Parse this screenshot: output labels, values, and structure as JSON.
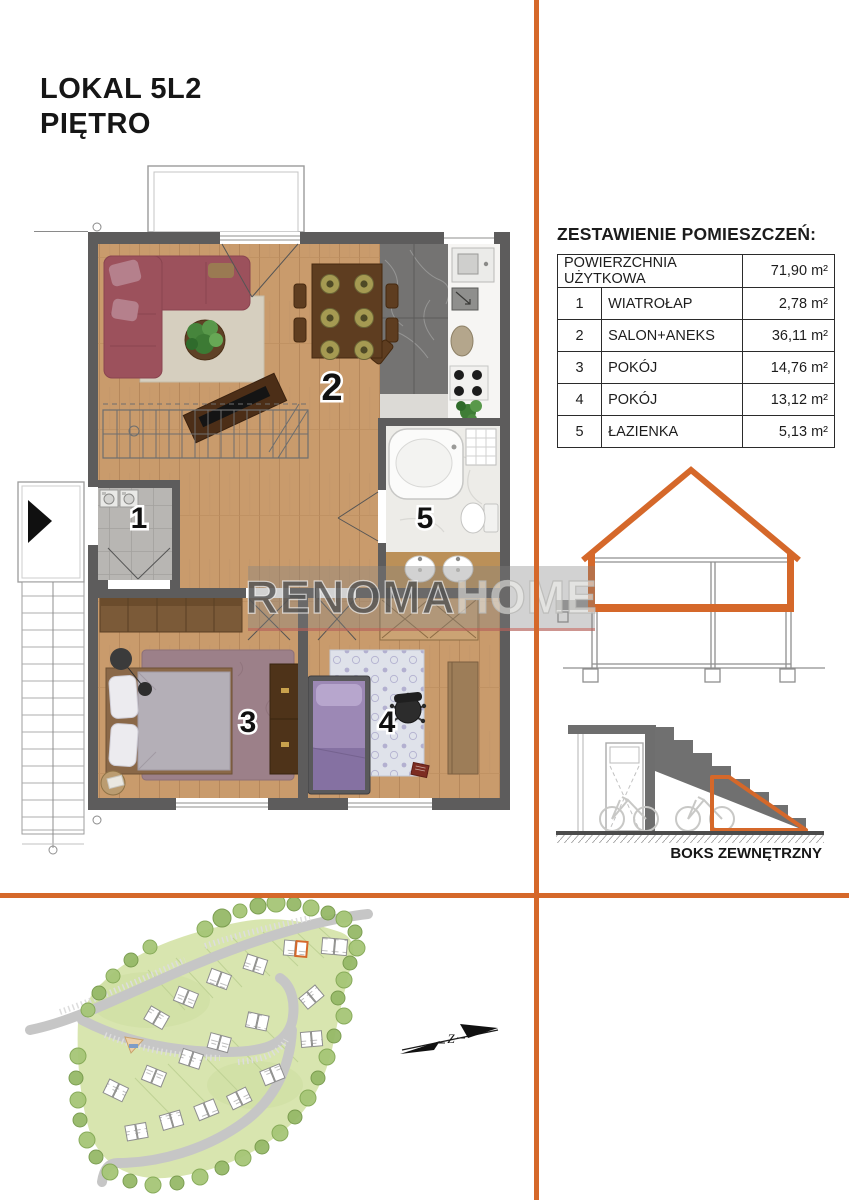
{
  "accent": "#d5682a",
  "header": {
    "title_line1": "LOKAL 5L2",
    "title_line2": "PIĘTRO"
  },
  "watermark": {
    "part1": "RENOMA",
    "part2": "HOME"
  },
  "room_table": {
    "heading": "ZESTAWIENIE POMIESZCZEŃ:",
    "total": {
      "label": "POWIERZCHNIA UŻYTKOWA",
      "area": "71,90 m²"
    },
    "rows": [
      {
        "num": "1",
        "name": "WIATROŁAP",
        "area": "2,78 m²"
      },
      {
        "num": "2",
        "name": "SALON+ANEKS",
        "area": "36,11 m²"
      },
      {
        "num": "3",
        "name": "POKÓJ",
        "area": "14,76 m²"
      },
      {
        "num": "4",
        "name": "POKÓJ",
        "area": "13,12 m²"
      },
      {
        "num": "5",
        "name": "ŁAZIENKA",
        "area": "5,13 m²"
      }
    ]
  },
  "floor_plan": {
    "labels": {
      "r1": "1",
      "r2": "2",
      "r3": "3",
      "r4": "4",
      "r5": "5"
    }
  },
  "sections": {
    "boks_label": "BOKS ZEWNĘTRZNY"
  },
  "site_plan": {
    "compass_label": "Z"
  }
}
